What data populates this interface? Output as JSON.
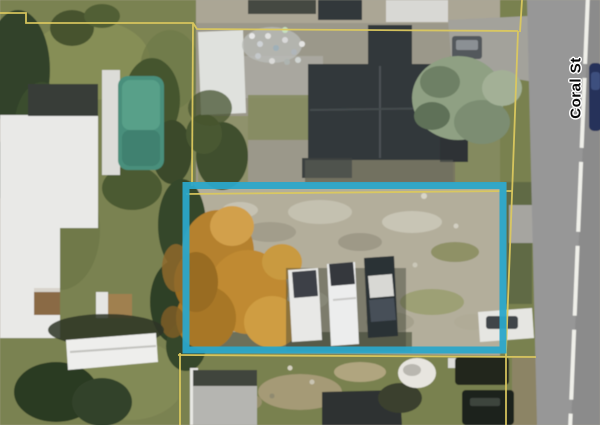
{
  "map_view": {
    "street_label": "Coral St",
    "highlight_color": "#2BA6C9",
    "boundary_color": "#DCC95E",
    "road_marking_color": "#EFEFE9"
  }
}
